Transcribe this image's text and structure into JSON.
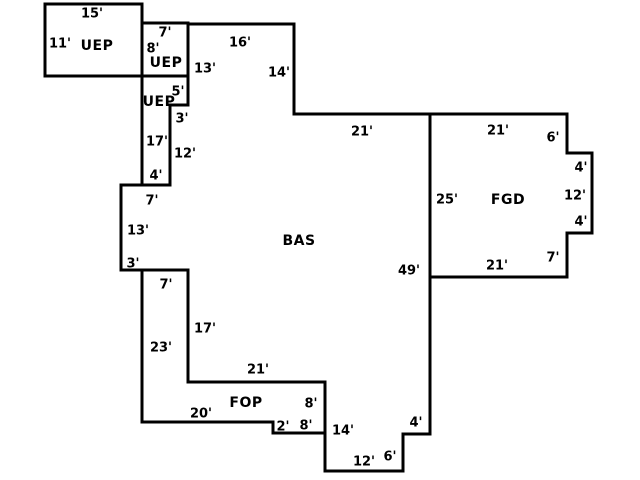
{
  "canvas": {
    "width": 640,
    "height": 480,
    "background_color": "#ffffff",
    "line_color": "#000000",
    "line_width": 3,
    "text_color": "#000000"
  },
  "sketch": {
    "type": "floorplan",
    "areas": [
      {
        "id": "uep-1",
        "label": "UEP",
        "label_pos": [
          97,
          45
        ],
        "points": [
          [
            45,
            4
          ],
          [
            142,
            4
          ],
          [
            142,
            76
          ],
          [
            45,
            76
          ]
        ],
        "dims": [
          {
            "text": "15'",
            "x": 92,
            "y": 13
          },
          {
            "text": "11'",
            "x": 60,
            "y": 43
          }
        ]
      },
      {
        "id": "uep-2",
        "label": "UEP",
        "label_pos": [
          166,
          62
        ],
        "points": [
          [
            142,
            23
          ],
          [
            188,
            23
          ],
          [
            188,
            76
          ],
          [
            142,
            76
          ]
        ],
        "dims": [
          {
            "text": "7'",
            "x": 165,
            "y": 32
          },
          {
            "text": "8'",
            "x": 153,
            "y": 48
          }
        ]
      },
      {
        "id": "uep-3",
        "label": "UEP",
        "label_pos": [
          159,
          101
        ],
        "points": [
          [
            142,
            76
          ],
          [
            188,
            76
          ],
          [
            188,
            105
          ],
          [
            170,
            105
          ],
          [
            170,
            185
          ],
          [
            142,
            185
          ]
        ],
        "dims": [
          {
            "text": "5'",
            "x": 178,
            "y": 91
          },
          {
            "text": "17'",
            "x": 157,
            "y": 141
          },
          {
            "text": "4'",
            "x": 156,
            "y": 175
          }
        ]
      },
      {
        "id": "bas",
        "label": "BAS",
        "label_pos": [
          299,
          240
        ],
        "points": [
          [
            188,
            24
          ],
          [
            294,
            24
          ],
          [
            294,
            114
          ],
          [
            430,
            114
          ],
          [
            430,
            434
          ],
          [
            403,
            434
          ],
          [
            403,
            471
          ],
          [
            325,
            471
          ],
          [
            325,
            382
          ],
          [
            188,
            382
          ],
          [
            188,
            270
          ],
          [
            121,
            270
          ],
          [
            121,
            185
          ],
          [
            170,
            185
          ],
          [
            170,
            105
          ],
          [
            188,
            105
          ]
        ],
        "dims": [
          {
            "text": "13'",
            "x": 205,
            "y": 68
          },
          {
            "text": "16'",
            "x": 240,
            "y": 42
          },
          {
            "text": "14'",
            "x": 279,
            "y": 72
          },
          {
            "text": "21'",
            "x": 362,
            "y": 131
          },
          {
            "text": "3'",
            "x": 182,
            "y": 118
          },
          {
            "text": "12'",
            "x": 185,
            "y": 153
          },
          {
            "text": "7'",
            "x": 152,
            "y": 200
          },
          {
            "text": "13'",
            "x": 138,
            "y": 230
          },
          {
            "text": "3'",
            "x": 133,
            "y": 263
          },
          {
            "text": "17'",
            "x": 205,
            "y": 328
          },
          {
            "text": "21'",
            "x": 258,
            "y": 369
          },
          {
            "text": "49'",
            "x": 409,
            "y": 270
          },
          {
            "text": "14'",
            "x": 343,
            "y": 430
          },
          {
            "text": "4'",
            "x": 416,
            "y": 422
          },
          {
            "text": "6'",
            "x": 390,
            "y": 456
          },
          {
            "text": "12'",
            "x": 364,
            "y": 461
          }
        ]
      },
      {
        "id": "fop",
        "label": "FOP",
        "label_pos": [
          246,
          402
        ],
        "points": [
          [
            142,
            270
          ],
          [
            188,
            270
          ],
          [
            188,
            382
          ],
          [
            325,
            382
          ],
          [
            325,
            433
          ],
          [
            273,
            433
          ],
          [
            273,
            422
          ],
          [
            142,
            422
          ]
        ],
        "dims": [
          {
            "text": "7'",
            "x": 166,
            "y": 284
          },
          {
            "text": "23'",
            "x": 161,
            "y": 347
          },
          {
            "text": "20'",
            "x": 201,
            "y": 413
          },
          {
            "text": "8'",
            "x": 311,
            "y": 403
          },
          {
            "text": "2'",
            "x": 283,
            "y": 426
          },
          {
            "text": "8'",
            "x": 306,
            "y": 425
          }
        ]
      },
      {
        "id": "fgd",
        "label": "FGD",
        "label_pos": [
          508,
          199
        ],
        "points": [
          [
            430,
            114
          ],
          [
            567,
            114
          ],
          [
            567,
            153
          ],
          [
            592,
            153
          ],
          [
            592,
            233
          ],
          [
            567,
            233
          ],
          [
            567,
            277
          ],
          [
            430,
            277
          ]
        ],
        "dims": [
          {
            "text": "21'",
            "x": 498,
            "y": 130
          },
          {
            "text": "6'",
            "x": 553,
            "y": 137
          },
          {
            "text": "4'",
            "x": 581,
            "y": 167
          },
          {
            "text": "25'",
            "x": 447,
            "y": 199
          },
          {
            "text": "12'",
            "x": 575,
            "y": 195
          },
          {
            "text": "4'",
            "x": 581,
            "y": 221
          },
          {
            "text": "7'",
            "x": 553,
            "y": 257
          },
          {
            "text": "21'",
            "x": 497,
            "y": 265
          }
        ]
      }
    ]
  }
}
